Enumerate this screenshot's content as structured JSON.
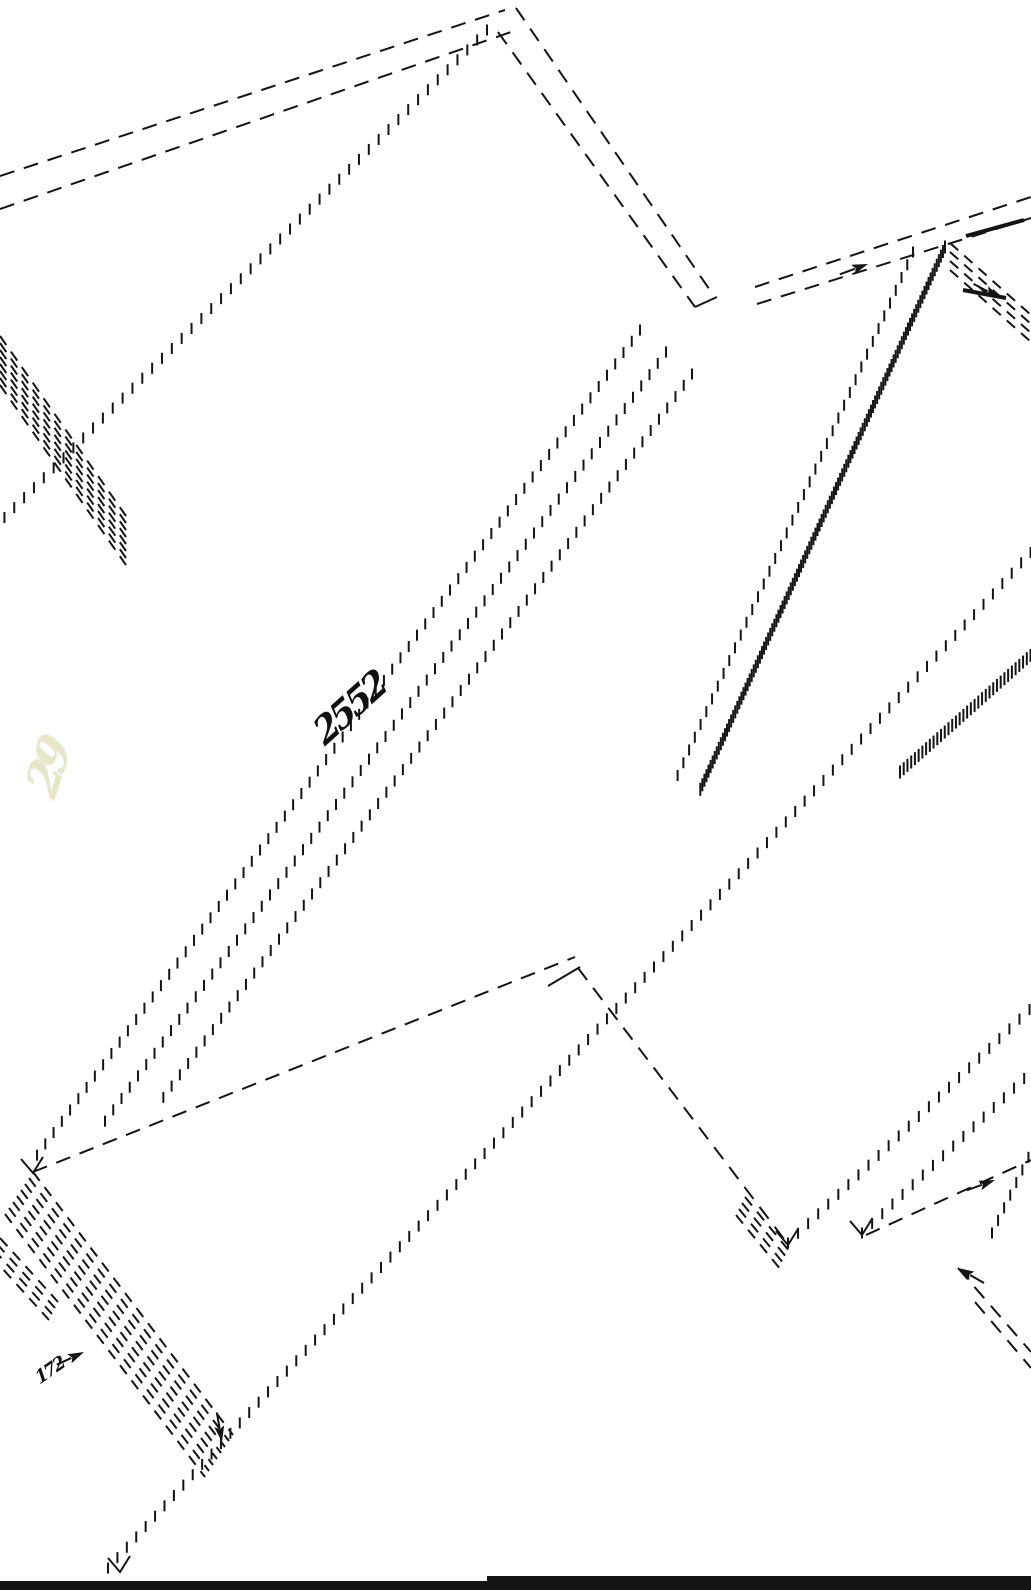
{
  "meta": {
    "background_color": "#ffffff",
    "ink_color": "#141414",
    "width": 1031,
    "height": 1590,
    "drawing_kind": "isometric exploded panel line drawing"
  },
  "annotations": {
    "center_scribble": "2552",
    "corner_scribble": "172",
    "watermark_scribble": "29"
  },
  "styles": {
    "dash": {
      "width": 2,
      "dasharray": "15,10"
    },
    "hband_dash": {
      "width": 2,
      "dasharray": "11,8"
    },
    "solid": {
      "width": 2
    },
    "solid3": {
      "width": 4
    },
    "ticks": {
      "spacing": 14,
      "len": 11,
      "width": 2
    },
    "zipper": {
      "spacing": 5,
      "len": 13,
      "width": 2
    }
  },
  "drawing": {
    "lines": [
      {
        "x1": 0,
        "y1": 176,
        "x2": 505,
        "y2": 10,
        "style": "dash"
      },
      {
        "x1": 0,
        "y1": 209,
        "x2": 514,
        "y2": 31,
        "style": "dash"
      },
      {
        "x1": 487,
        "y1": 30,
        "x2": 0,
        "y2": 522,
        "style": "ticks"
      },
      {
        "x1": 516,
        "y1": 8,
        "x2": 714,
        "y2": 296,
        "style": "dash"
      },
      {
        "x1": 498,
        "y1": 32,
        "x2": 695,
        "y2": 307,
        "style": "dash"
      },
      {
        "x1": 695,
        "y1": 307,
        "x2": 717,
        "y2": 297,
        "style": "solid"
      },
      {
        "x1": 640,
        "y1": 330,
        "x2": 35,
        "y2": 1158,
        "style": "ticks"
      },
      {
        "x1": 666,
        "y1": 352,
        "x2": 100,
        "y2": 1128,
        "style": "ticks"
      },
      {
        "x1": 692,
        "y1": 374,
        "x2": 160,
        "y2": 1102,
        "style": "ticks"
      },
      {
        "x1": 33,
        "y1": 1172,
        "x2": 575,
        "y2": 957,
        "style": "dash"
      },
      {
        "x1": 548,
        "y1": 986,
        "x2": 580,
        "y2": 967,
        "style": "solid"
      },
      {
        "x1": 578,
        "y1": 968,
        "x2": 787,
        "y2": 1243,
        "style": "dash"
      },
      {
        "x1": 108,
        "y1": 1568,
        "x2": 1031,
        "y2": 552,
        "style": "ticks"
      },
      {
        "x1": 755,
        "y1": 287,
        "x2": 1031,
        "y2": 197,
        "style": "dash"
      },
      {
        "x1": 757,
        "y1": 304,
        "x2": 1031,
        "y2": 218,
        "style": "dash"
      },
      {
        "x1": 966,
        "y1": 236,
        "x2": 1024,
        "y2": 220,
        "style": "solid3"
      },
      {
        "x1": 963,
        "y1": 290,
        "x2": 1006,
        "y2": 298,
        "style": "solid3"
      },
      {
        "x1": 945,
        "y1": 247,
        "x2": 700,
        "y2": 790,
        "style": "zipper"
      },
      {
        "x1": 913,
        "y1": 252,
        "x2": 672,
        "y2": 788,
        "style": "ticks"
      },
      {
        "x1": 900,
        "y1": 772,
        "x2": 1031,
        "y2": 655,
        "style": "zipper"
      },
      {
        "x1": 788,
        "y1": 1243,
        "x2": 1031,
        "y2": 1008,
        "style": "ticks"
      },
      {
        "x1": 862,
        "y1": 1233,
        "x2": 1031,
        "y2": 1072,
        "style": "ticks"
      },
      {
        "x1": 866,
        "y1": 1235,
        "x2": 1031,
        "y2": 1160,
        "style": "dash"
      },
      {
        "x1": 992,
        "y1": 1233,
        "x2": 1031,
        "y2": 1152,
        "style": "ticks"
      },
      {
        "x1": 958,
        "y1": 1268,
        "x2": 1031,
        "y2": 1352,
        "style": "dash"
      },
      {
        "x1": 975,
        "y1": 1302,
        "x2": 1031,
        "y2": 1368,
        "style": "dash"
      }
    ],
    "hbands": [
      {
        "x1": 0,
        "y1": 336,
        "x2": 126,
        "y2": 516,
        "n": 8,
        "ox": 0,
        "oy": 7
      },
      {
        "x1": 33,
        "y1": 1172,
        "x2": 233,
        "y2": 1435,
        "n": 8,
        "ox": -4,
        "oy": 6
      },
      {
        "x1": 0,
        "y1": 1238,
        "x2": 58,
        "y2": 1302,
        "n": 4,
        "ox": -3,
        "oy": 6
      },
      {
        "x1": 950,
        "y1": 243,
        "x2": 1031,
        "y2": 315,
        "n": 4,
        "ox": 0,
        "oy": 9
      },
      {
        "x1": 745,
        "y1": 1197,
        "x2": 790,
        "y2": 1252,
        "n": 4,
        "ox": -3,
        "oy": 6
      }
    ],
    "arrows": [
      {
        "x": 868,
        "y": 264,
        "angle": -20
      },
      {
        "x": 1000,
        "y": 298,
        "angle": 28
      },
      {
        "x": 995,
        "y": 1180,
        "angle": -20
      },
      {
        "x": 958,
        "y": 1268,
        "angle": -150
      },
      {
        "x": 222,
        "y": 1442,
        "angle": 80
      },
      {
        "x": 84,
        "y": 1352,
        "angle": -25
      }
    ],
    "vmarks": [
      {
        "x": 33,
        "y": 1173
      },
      {
        "x": 788,
        "y": 1245
      },
      {
        "x": 862,
        "y": 1235
      },
      {
        "x": 120,
        "y": 1572
      }
    ],
    "bars": [
      {
        "x": 0,
        "y": 1581,
        "w": 1031,
        "h": 9
      },
      {
        "x": 487,
        "y": 1576,
        "w": 544,
        "h": 14
      }
    ]
  }
}
